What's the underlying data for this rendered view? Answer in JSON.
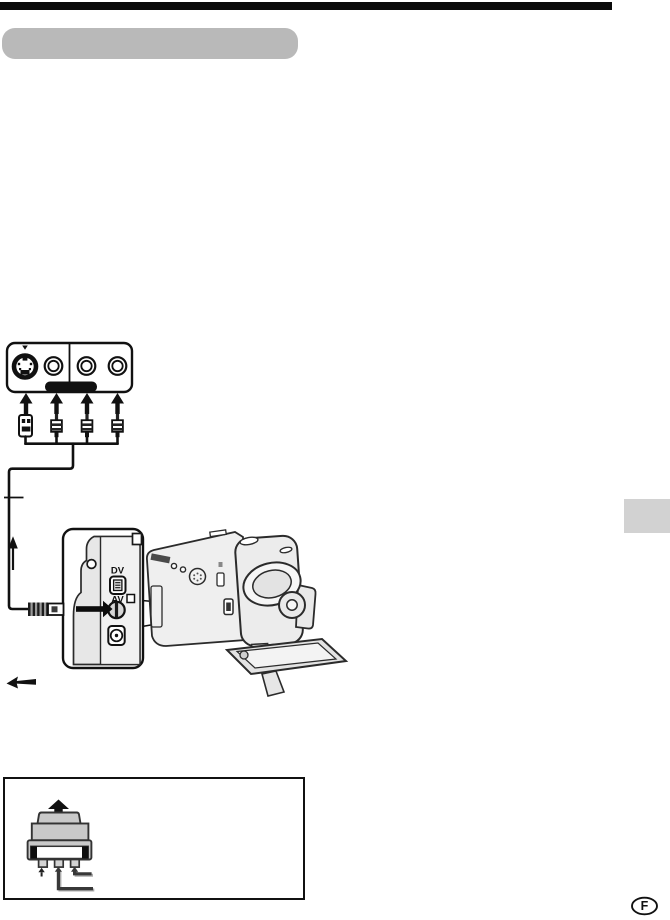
{
  "page": {
    "kind": "camcorder-manual-connection-page",
    "background": "#ffffff"
  },
  "header": {
    "top_rule_color": "#0a0a0a",
    "section_pill_color": "#b9b9b9"
  },
  "tv_jack_panel": {
    "jack_icons": [
      "s-video-jack",
      "video-rca-jack",
      "audio-left-rca-jack",
      "audio-right-rca-jack"
    ],
    "plug_icons": [
      "s-video-plug",
      "rca-plug",
      "rca-plug",
      "rca-plug"
    ],
    "highlight_bar_color": "#111111"
  },
  "cable": {
    "direction_arrow": "up",
    "flow_arrow": "left"
  },
  "camcorder_closeup": {
    "dv_port_label": "DV",
    "av_jack_label": "AV",
    "insert_arrow": "right"
  },
  "side_tab": {
    "color": "#d2d2d2"
  },
  "adapter_box": {
    "adapter_icon": "21-pin-scart-adapter",
    "arrow_up": true,
    "bottom_plug_count": 3
  },
  "footer": {
    "page_marker": "F"
  },
  "colors": {
    "line": "#111111",
    "camcorder_fill": "#ececec",
    "adapter_fill": "#c9c9c9",
    "callout_shadow": "#ababab"
  }
}
